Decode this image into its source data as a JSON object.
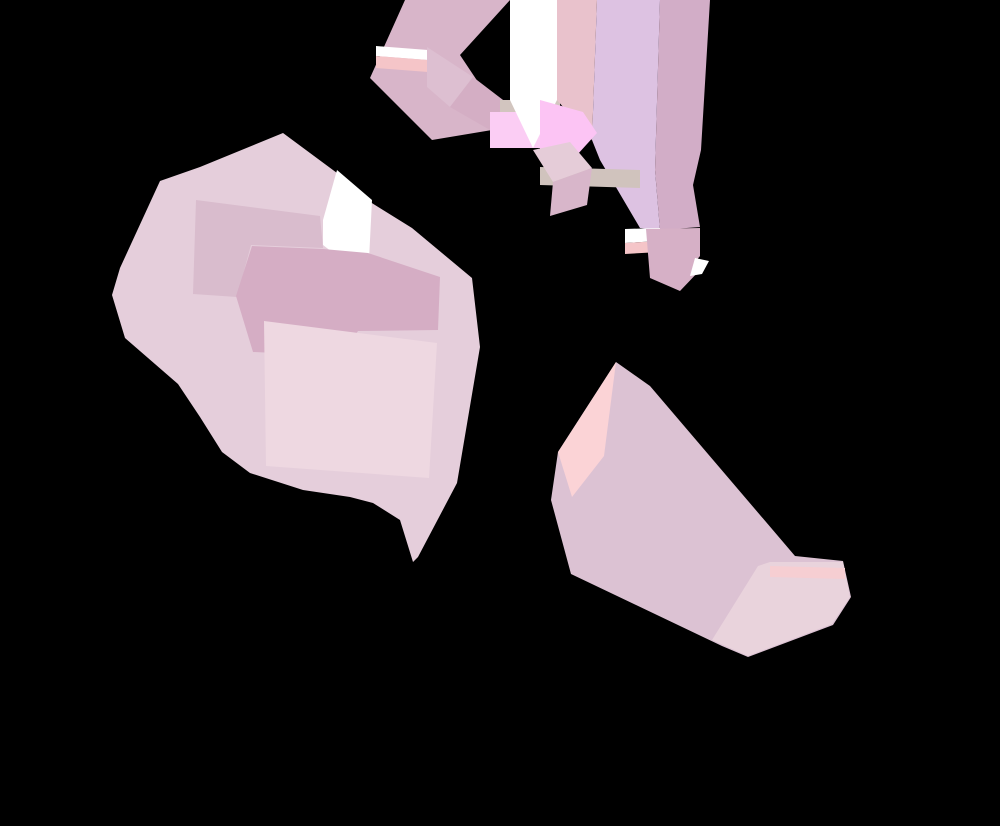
{
  "canvas": {
    "width": 1000,
    "height": 826,
    "background": "#000000",
    "kind": "abstract-polygon-composition"
  },
  "palette": {
    "background": "#000000",
    "pale_pink": "#e5cedb",
    "medium_mauve": "#d9bccd",
    "dark_mauve": "#d5adc4",
    "light_pink": "#eed8e1",
    "white": "#ffffff",
    "salmon": "#f5c5c8",
    "bright_pink": "#fbcdf4",
    "lavender_pink": "#ddc2e2",
    "taupe": "#d0c3bd",
    "boot_mauve": "#dcc2d3",
    "toe_pink": "#e9d3dc",
    "heel_pink": "#fbd3d6"
  },
  "shapes": [
    {
      "name": "blob-base",
      "fill": "#e5cedb",
      "points": "283,133 337,173 367,200 412,228 472,278 480,347 457,483 418,557 413,562 400,520 373,503 350,497 303,490 250,473 222,452 200,417 178,384 125,338 112,295 120,268 160,181 200,167"
    },
    {
      "name": "blob-upper-band",
      "fill": "#d9bccd",
      "points": "193,294 196,200 320,216 323,248 251,245 237,297"
    },
    {
      "name": "blob-white-patch",
      "fill": "#ffffff",
      "points": "323,220 337,170 372,200 368,280 323,245"
    },
    {
      "name": "blob-arrow",
      "fill": "#d5adc4",
      "points": "236,296 252,246 323,249 368,253 440,277 438,330 358,331 341,356 253,352"
    },
    {
      "name": "blob-light-square",
      "fill": "#eed8e1",
      "points": "264,321 437,343 429,478 266,466"
    },
    {
      "name": "dash-large",
      "fill": "#d8b5c9",
      "points": "405,0 510,0 460,55 500,115 492,130 432,140 370,78"
    },
    {
      "name": "dash-white-stripe",
      "fill": "#ffffff",
      "points": "376,46 428,50 428,60 376,56"
    },
    {
      "name": "dash-salmon-stripe",
      "fill": "#f5c5c8",
      "points": "376,56 428,60 428,72 376,68"
    },
    {
      "name": "cube1-top-face",
      "fill": "#ddbfd1",
      "points": "427,47 473,77 450,107 427,87"
    },
    {
      "name": "cube1-side-face",
      "fill": "#d4aec4",
      "points": "450,107 473,77 507,103 490,130"
    },
    {
      "name": "taupe-patch",
      "fill": "#d2c5bf",
      "points": "500,100 560,100 560,112 500,112"
    },
    {
      "name": "bright-pink-patch-1",
      "fill": "#fbcdf4",
      "points": "490,112 560,112 560,148 490,148"
    },
    {
      "name": "white-band",
      "fill": "#ffffff",
      "points": "510,0 557,0 557,100 533,148 510,100"
    },
    {
      "name": "tall-band-left",
      "fill": "#e9c2cc",
      "points": "557,0 597,0 592,140 557,100"
    },
    {
      "name": "tall-band-main",
      "fill": "#ddc2e2",
      "points": "597,0 660,0 655,170 660,230 640,228 600,160 592,140"
    },
    {
      "name": "tall-band-right",
      "fill": "#d2adc7",
      "points": "660,0 710,0 701,150 693,185 700,227 660,230 655,170"
    },
    {
      "name": "bright-pink-patch-2",
      "fill": "#fcc4f4",
      "points": "540,100 583,112 597,133 577,155 540,150"
    },
    {
      "name": "taupe-stripe",
      "fill": "#d0c3bd",
      "points": "540,167 640,170 640,188 540,185"
    },
    {
      "name": "cube2-top-face",
      "fill": "#e5ccd8",
      "points": "533,150 570,142 592,168 553,182"
    },
    {
      "name": "cube2-side-face",
      "fill": "#d8b6ca",
      "points": "553,182 592,168 587,205 550,216"
    },
    {
      "name": "cube3-white-stripe",
      "fill": "#ffffff",
      "points": "625,229 660,228 660,241 625,243"
    },
    {
      "name": "cube3-salmon-stripe",
      "fill": "#f5c5c8",
      "points": "625,243 660,241 660,252 625,254"
    },
    {
      "name": "cube3-face",
      "fill": "#d6b0c6",
      "points": "646,229 700,228 700,256 695,262 700,270 680,291 650,278"
    },
    {
      "name": "cube3-white-notch",
      "fill": "#ffffff",
      "points": "695,258 709,261 702,274 690,276"
    },
    {
      "name": "boot-band",
      "fill": "#dcc2d3",
      "points": "616,362 650,386 795,556 843,561 851,597 833,625 748,657 722,646 571,574 551,500 558,452"
    },
    {
      "name": "boot-heel-light",
      "fill": "#fbd3d6",
      "points": "616,362 558,452 572,497 604,456"
    },
    {
      "name": "boot-toe-light",
      "fill": "#e9d3dc",
      "points": "770,562 843,562 850,597 832,624 748,656 712,640 758,566"
    },
    {
      "name": "boot-toe-salmon",
      "fill": "#f6ced2",
      "points": "770,566 845,568 845,579 770,577"
    }
  ]
}
